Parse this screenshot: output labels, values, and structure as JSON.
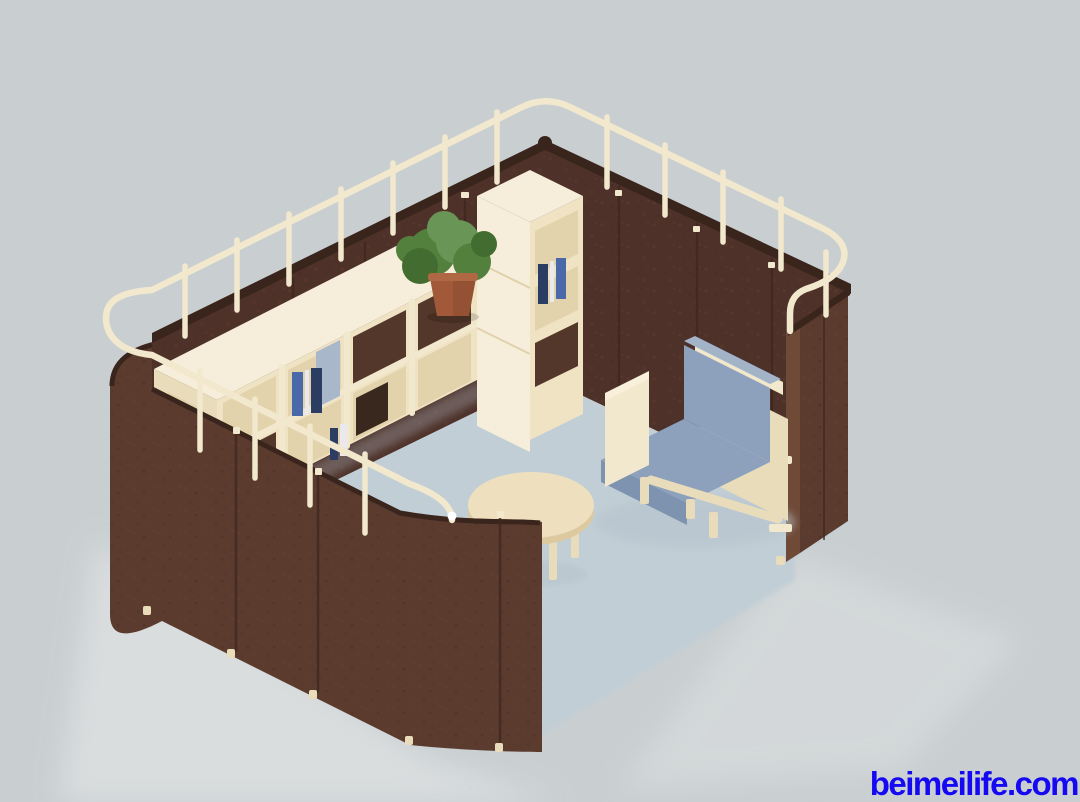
{
  "watermark": {
    "text": "beimeilife.com",
    "color": "#1508f2"
  },
  "colors": {
    "background": "#c9cfd1",
    "floor": "#c1ced6",
    "floor_highlight": "#dcdfe0",
    "panel_outer": "#5a3b2e",
    "panel_inner": "#4e322a",
    "panel_top": "#3a251d",
    "panel_curl": "#6f4a37",
    "panel_seam": "#40281e",
    "cream": "#f2e8cd",
    "cream_mid": "#e9dcba",
    "cream_dark": "#dcc9a0",
    "shelf_top": "#f6eeda",
    "shelf_face": "#efe3c4",
    "shelf_interior": "#e3d3ad",
    "shelf_cell_dark": "#53372a",
    "cushion": "#8da1bc",
    "cushion_dark": "#7e93af",
    "cushion_top": "#a3b4c9",
    "pot": "#a2593a",
    "pot_dark": "#7e4229",
    "leaf": "#54803e",
    "leaf_dark": "#436c30",
    "leaf_light": "#699556",
    "book_blue": "#4a69a8",
    "book_navy": "#2c3d64",
    "book_white": "#eaeaee",
    "binder_blue": "#a9b7cb",
    "box_dark": "#39281e",
    "shadow": "#b7c3cc",
    "rail_cap": "#ffffff"
  }
}
